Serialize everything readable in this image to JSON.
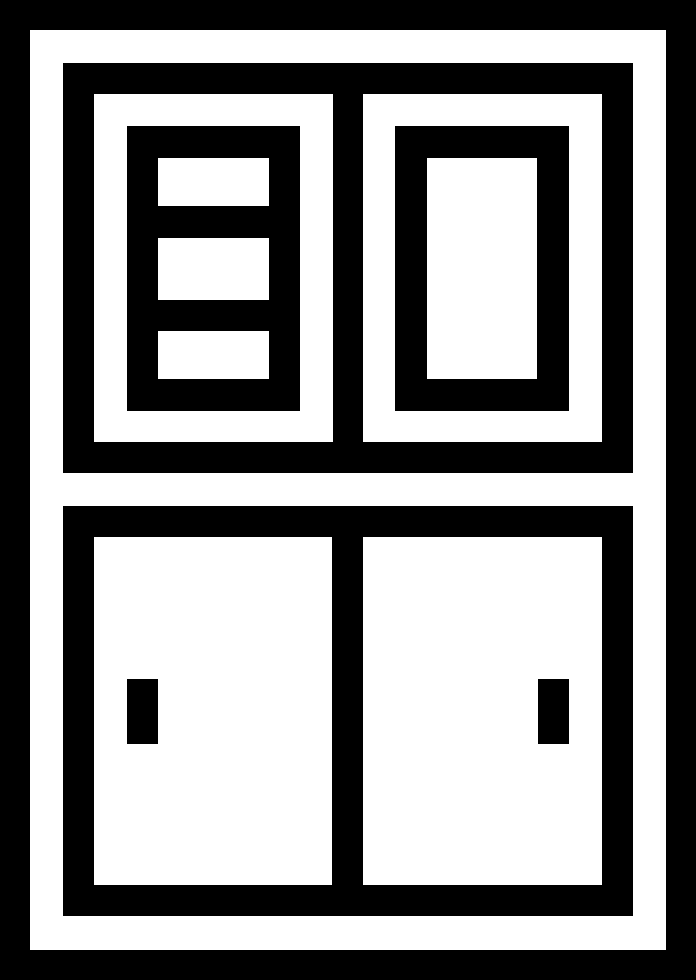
{
  "icon": {
    "name": "cupboard-cabinet-icon",
    "style": "glyph",
    "parts": {
      "outer_frame": "outer border of cabinet",
      "top_left_panel": "drawer stack with three slots",
      "top_right_panel": "framed cabinet door",
      "bottom_section": "two sliding doors",
      "handles": "two vertical door handles"
    }
  },
  "colors": {
    "foreground": "#000000",
    "background": "#ffffff"
  }
}
